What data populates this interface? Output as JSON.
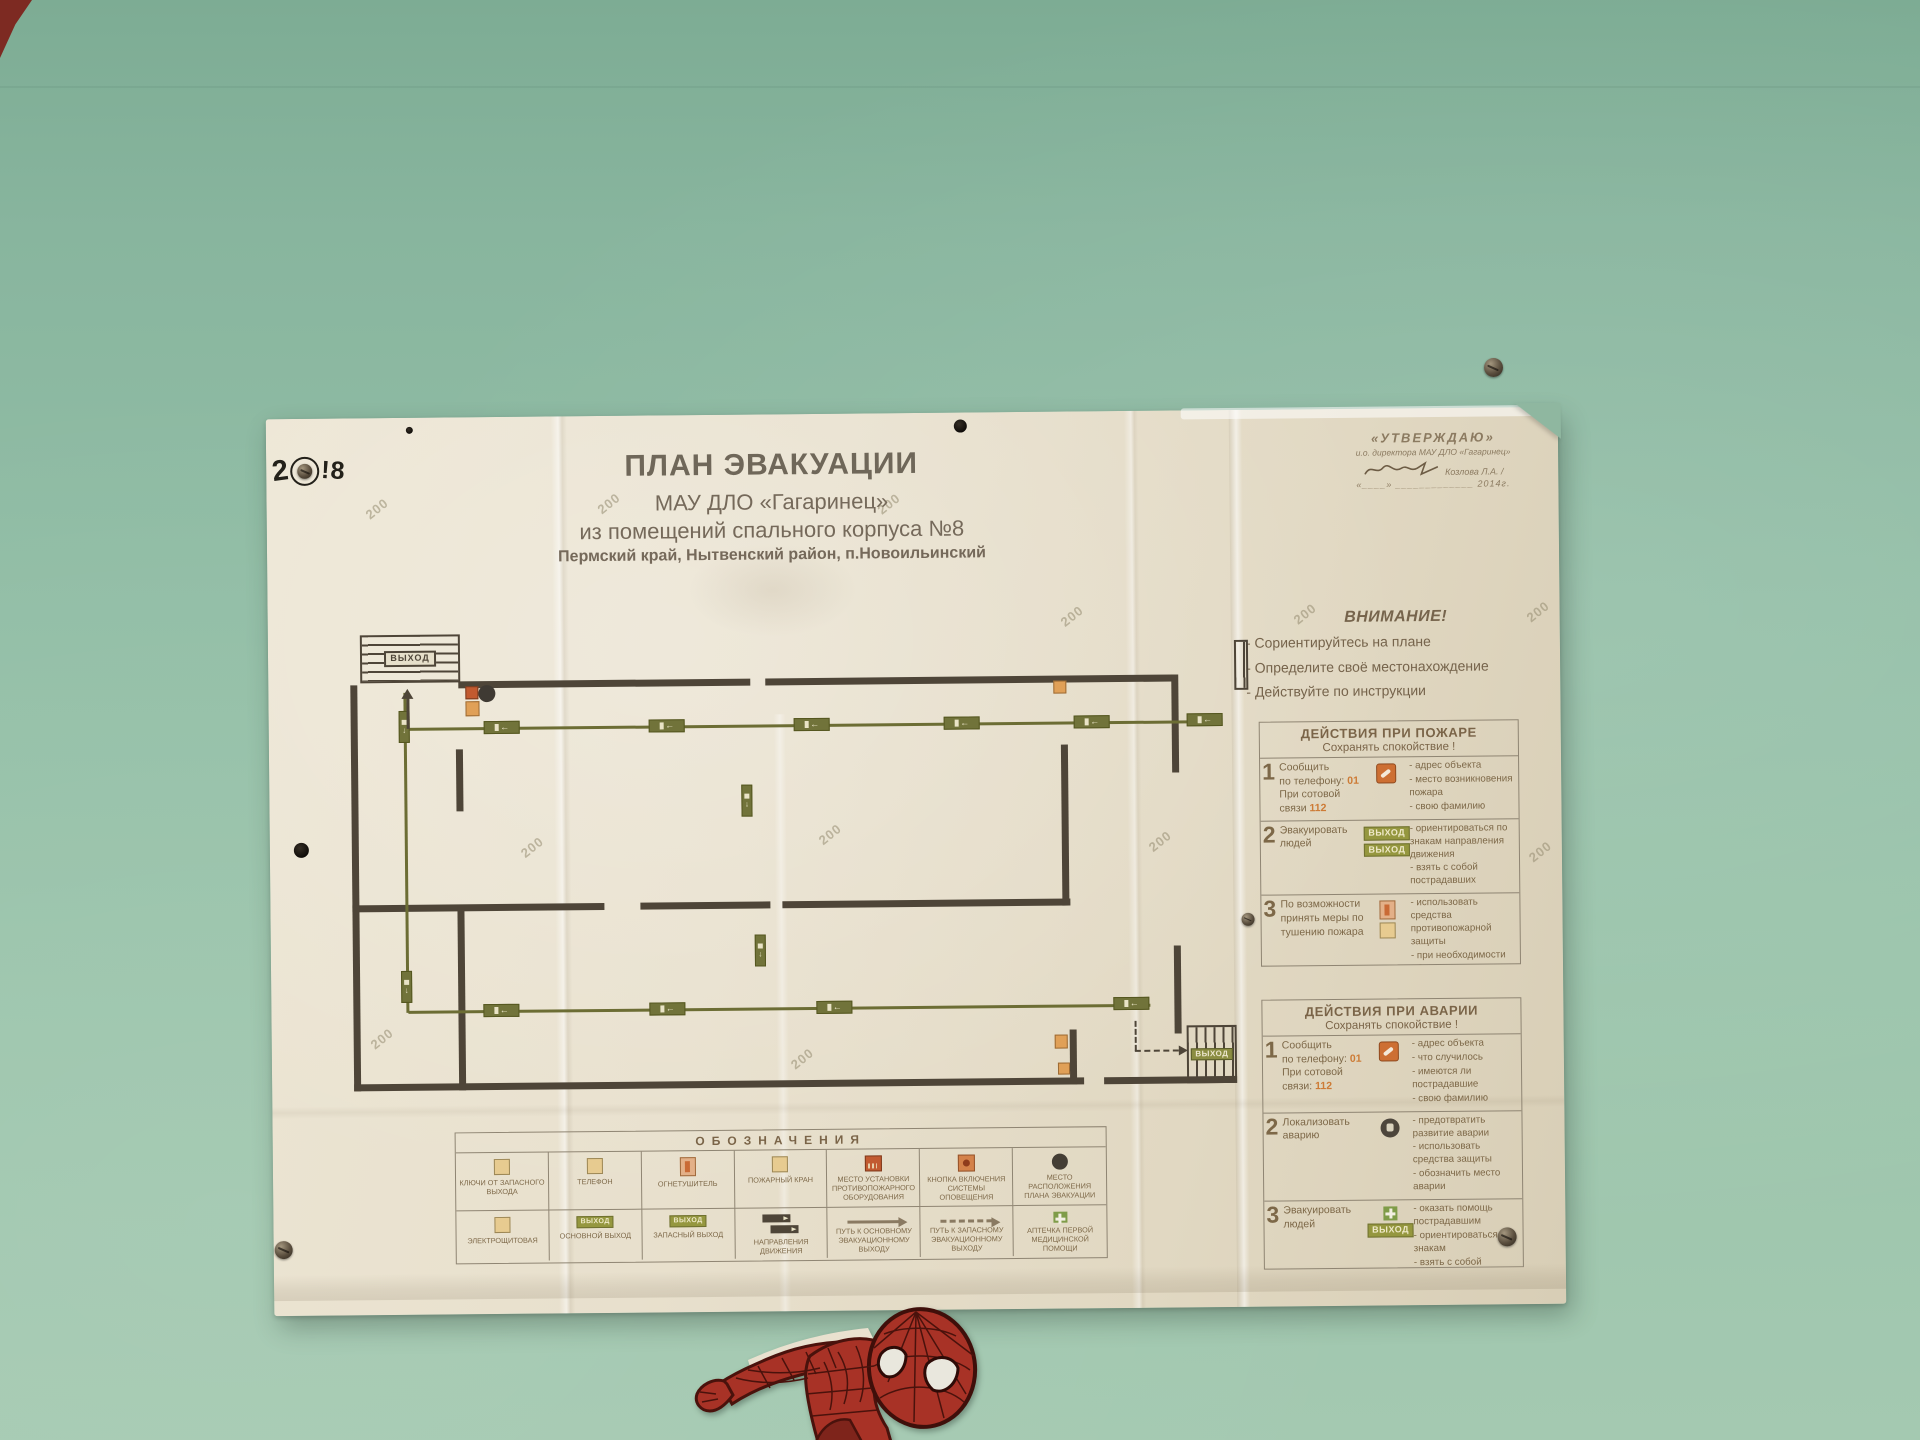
{
  "colors": {
    "wall_green": "#93bda6",
    "poster_cream": "#e8e0cd",
    "text_brown": "#7d6848",
    "accent_orange": "#cd7b36",
    "route_olive": "#71733a",
    "plan_wall": "#4e4538"
  },
  "poster": {
    "exit_label": "ВЫХОД",
    "watermark": "200",
    "title": "ПЛАН ЭВАКУАЦИИ",
    "subtitle_org": "МАУ ДЛО «Гагаринец»",
    "subtitle_building": "из помещений спального корпуса №8",
    "subtitle_location": "Пермский край, Нытвенский район, п.Новоильинский",
    "approval": {
      "header": "«УТВЕРЖДАЮ»",
      "role": "и.о. директора МАУ ДЛО «Гагаринец»",
      "signed_by": "Козлова Л.А. /",
      "date_line": "«____» _____________ 2014г."
    },
    "attention": {
      "title": "ВНИМАНИЕ!",
      "items": [
        "- Сориентируйтесь на плане",
        "- Определите своё местонахождение",
        "- Действуйте по инструкции"
      ]
    },
    "fire": {
      "title": "ДЕЙСТВИЯ ПРИ ПОЖАРЕ",
      "calm": "Сохранять спокойствие !",
      "r1": {
        "num": "1",
        "a1": "Сообщить",
        "a2": "по телефону: ",
        "phone1": "01",
        "a3": "При сотовой",
        "a4": "связи ",
        "phone2": "112",
        "d": [
          "- адрес объекта",
          "- место возникновения пожара",
          "- свою фамилию"
        ]
      },
      "r2": {
        "num": "2",
        "action": "Эвакуировать людей",
        "d": [
          "- ориентироваться по знакам направления движения",
          "- взять с собой пострадавших"
        ]
      },
      "r3": {
        "num": "3",
        "action": "По возможности принять меры по тушению пожара",
        "d": [
          "- использовать средства противопожарной защиты",
          "- при необходимости обесточить помещения"
        ]
      }
    },
    "accident": {
      "title": "ДЕЙСТВИЯ ПРИ АВАРИИ",
      "calm": "Сохранять спокойствие !",
      "r1": {
        "num": "1",
        "a1": "Сообщить",
        "a2": "по телефону: ",
        "phone1": "01",
        "a3": "При сотовой",
        "a4": "связи: ",
        "phone2": "112",
        "d": [
          "- адрес объекта",
          "- что случилось",
          "- имеются ли пострадавшие",
          "- свою фамилию"
        ]
      },
      "r2": {
        "num": "2",
        "action": "Локализовать аварию",
        "d": [
          "- предотвратить развитие аварии",
          "- использовать средства защиты",
          "- обозначить место аварии"
        ]
      },
      "r3": {
        "num": "3",
        "action": "Эвакуировать людей",
        "d": [
          "- оказать помощь пострадавшим",
          "- ориентироваться по знакам",
          "- взять с собой пострадавших"
        ]
      }
    },
    "legend": {
      "title": "ОБОЗНАЧЕНИЯ",
      "items": [
        "КЛЮЧИ ОТ ЗАПАСНОГО ВЫХОДА",
        "ТЕЛЕФОН",
        "ОГНЕТУШИТЕЛЬ",
        "ПОЖАРНЫЙ КРАН",
        "МЕСТО УСТАНОВКИ ПРОТИВОПОЖАРНОГО ОБОРУДОВАНИЯ",
        "КНОПКА ВКЛЮЧЕНИЯ СИСТЕМЫ ОПОВЕЩЕНИЯ",
        "МЕСТО РАСПОЛОЖЕНИЯ ПЛАНА ЭВАКУАЦИИ",
        "ЭЛЕКТРОЩИТОВАЯ",
        "ОСНОВНОЙ ВЫХОД",
        "ЗАПАСНЫЙ ВЫХОД",
        "НАПРАВЛЕНИЯ ДВИЖЕНИЯ",
        "ПУТЬ К ОСНОВНОМУ ЭВАКУАЦИОННОМУ ВЫХОДУ",
        "ПУТЬ К ЗАПАСНОМУ ЭВАКУАЦИОННОМУ ВЫХОДУ",
        "АПТЕЧКА ПЕРВОЙ МЕДИЦИНСКОЙ ПОМОЩИ"
      ]
    },
    "watermark_positions": [
      [
        98,
        83
      ],
      [
        610,
        83
      ],
      [
        330,
        80
      ],
      [
        792,
        197
      ],
      [
        1025,
        197
      ],
      [
        1258,
        197
      ],
      [
        250,
        423
      ],
      [
        548,
        413
      ],
      [
        878,
        423
      ],
      [
        1258,
        437
      ],
      [
        98,
        613
      ],
      [
        518,
        637
      ]
    ]
  },
  "graffiti": {
    "left": "2",
    "right": "!8"
  },
  "plan": {
    "walls": [
      [
        2,
        54,
        7,
        406
      ],
      [
        110,
        51,
        292,
        7
      ],
      [
        417,
        51,
        408,
        7
      ],
      [
        823,
        51,
        7,
        98
      ],
      [
        823,
        322,
        7,
        88
      ],
      [
        2,
        274,
        252,
        7
      ],
      [
        290,
        274,
        130,
        7
      ],
      [
        432,
        274,
        288,
        7
      ],
      [
        712,
        120,
        7,
        161
      ],
      [
        107,
        119,
        7,
        62
      ],
      [
        107,
        277,
        7,
        183
      ],
      [
        2,
        453,
        730,
        7
      ],
      [
        752,
        453,
        133,
        7
      ],
      [
        718,
        405,
        7,
        55
      ]
    ],
    "routes": [
      [
        57,
        97,
        782,
        3
      ],
      [
        55,
        62,
        3,
        320
      ],
      [
        57,
        380,
        742,
        3
      ]
    ],
    "badges_h": [
      [
        135,
        91
      ],
      [
        300,
        91
      ],
      [
        445,
        91
      ],
      [
        595,
        91
      ],
      [
        725,
        91
      ],
      [
        838,
        90
      ],
      [
        132,
        374
      ],
      [
        298,
        374
      ],
      [
        465,
        374
      ],
      [
        762,
        373
      ]
    ],
    "badges_v": [
      [
        50,
        80
      ],
      [
        392,
        157
      ],
      [
        404,
        307
      ],
      [
        50,
        340
      ]
    ],
    "icons": [
      {
        "t": "red",
        "x": 117,
        "y": 56,
        "w": 13,
        "h": 13
      },
      {
        "t": "orange",
        "x": 117,
        "y": 71,
        "w": 14,
        "h": 15
      },
      {
        "t": "dot",
        "x": 130,
        "y": 55,
        "w": 17,
        "h": 17
      },
      {
        "t": "orange",
        "x": 705,
        "y": 56,
        "w": 13,
        "h": 13
      },
      {
        "t": "orange",
        "x": 703,
        "y": 410,
        "w": 13,
        "h": 14
      },
      {
        "t": "orange",
        "x": 706,
        "y": 438,
        "w": 12,
        "h": 12
      }
    ],
    "stairs_tl": {
      "x": 12,
      "y": 4,
      "w": 100,
      "h": 48
    },
    "stairs_br": {
      "x": 835,
      "y": 402,
      "w": 50,
      "h": 58
    },
    "hatch_tr": {
      "x": 886,
      "y": 17,
      "w": 14,
      "h": 50
    },
    "arrow_up": {
      "x": 53,
      "y": 58,
      "len": 40
    },
    "dashed": {
      "vx": 783,
      "vy": 397,
      "vlen": 30,
      "hx": 783,
      "hy": 426,
      "hlen": 44
    }
  }
}
